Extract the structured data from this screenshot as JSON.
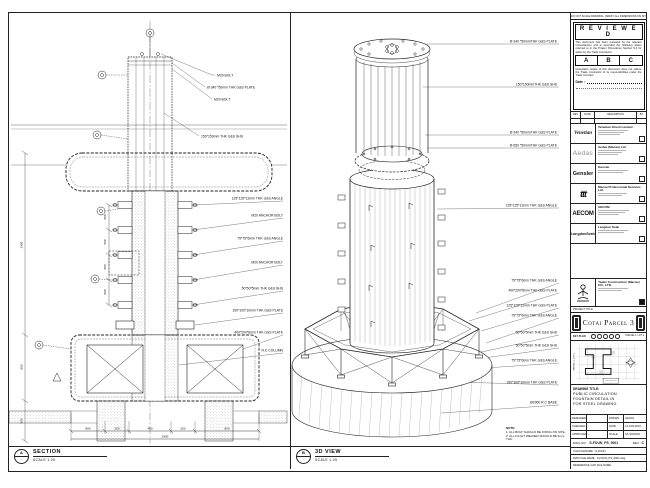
{
  "section_view": {
    "marker": "A",
    "label": "SECTION",
    "scale": "SCALE 1:25",
    "callouts_top": [
      "M20 BOLT",
      "Ø 340 *50mm THK G&S PLATE",
      "M20 BOLT",
      "150*150mm THK G&S SHS"
    ],
    "callouts_right": [
      "125*125*12mm THK G&S ANGLE",
      "M20 ANCHOR BOLT",
      "75*75*6mm THK G&S ANGLE",
      "M20 ANCHOR BOLT",
      "50*50*5mm THK G&S SHS",
      "150*100*10mm THK G&S PLATE",
      "400*200*8mm THK G&S PLATE",
      "R.C COLUMN"
    ],
    "dims_left": [
      "500",
      "500",
      "500",
      "500"
    ],
    "side_dims": [
      "2400",
      "800",
      "500"
    ],
    "dims_bottom": [
      "800",
      "200",
      "450",
      "200",
      "800"
    ],
    "dim_total": "2900"
  },
  "iso_view": {
    "marker": "B",
    "label": "3D VIEW",
    "scale": "SCALE 1:25",
    "callouts": [
      "Ø 340 *50mmTHK G&S PLATE",
      "150*150mmTHK G&S SHS",
      "Ø 340 *50mmTHK G&S PLATE",
      "Ø 650 *50mmTHK G&S PLATE",
      "125*125*12mm THK G&S ANGLE",
      "75*75*6mm THK G&S ANGLE",
      "400*200*8mm THK G&S PLATE",
      "125*125*12mm THK G&S PLATE",
      "75*75*6mm THK G&S ANGLE",
      "50*50*5mm THK G&S SHS",
      "50*50*5mm THK G&S SHS",
      "75*75*6mm THK G&S ANGLE",
      "150*100*10mm THK G&S PLATE",
      "Ø2900 R.C BASE"
    ]
  },
  "notes": {
    "title": "NOTE:",
    "items": [
      "1. ALL BOLT SHOULD BE FIXING ON SITE.",
      "2. ALL FILLET WELDED SHOULD BE 6mm THK."
    ]
  },
  "titleblock": {
    "top_note": "DO NOT SCALE DRAWING. VERIFY ALL DIMENSIONS ON SITE",
    "reviewed": {
      "header": "R E V I E W E D",
      "para1": "This document has been reviewed by the relevant Consultant(s) and is accorded the following status referred to in the Project Procedures Section 5.4 for action by the Trade Contractor.",
      "options": [
        "A",
        "B",
        "C"
      ],
      "para2": "Consultant review of this document does not relieve the Trade Contractor of its responsibilities under the Trade Contract.",
      "date_label": "Date :"
    },
    "rev_table": {
      "headers": [
        "REV",
        "DATE",
        "DESCRIPTION",
        "BY"
      ]
    },
    "consultants": [
      {
        "logo_text": "Venetian",
        "name": "Venetian Orient Limited"
      },
      {
        "logo_text": "Aedas",
        "name": "Aedas (Macau) Ltd."
      },
      {
        "logo_text": "Gensler",
        "name": "Gensler"
      },
      {
        "logo_text": "ttt",
        "name": "Macau Professional Services Ltd."
      },
      {
        "logo_text": "AECOM",
        "name": "AECOM"
      },
      {
        "logo_text": "LangdonSeah",
        "name": "Langdon Seah"
      }
    ],
    "contractor": {
      "name": "Yadex Construction (Macau) CO., LTD."
    },
    "project": {
      "label": "PROJECT TITLE",
      "name": "Cotai Parcel 3"
    },
    "keyplan": {
      "label": "KEY PLAN",
      "parcel_right": "PARCEL 1, LOT 2",
      "parcel_left": "PARCEL 1, LOT 1"
    },
    "drawing_title": {
      "label": "DRAWING TITLE:",
      "lines": [
        "PUBLIC CIRCULATION",
        "FOUNTAIN DETAIL IN",
        "FOR STEEL DRAWING"
      ]
    },
    "fields": {
      "designed_label": "DESIGNED",
      "designed": "",
      "drawn_label": "DRAWN",
      "drawn": "LEUNG",
      "checked_label": "CHECKED",
      "checked": "-",
      "date_label": "DATE",
      "date": "14-JAN-2015",
      "approved_label": "APPROVED",
      "approved": "-",
      "scale_label": "SCALE",
      "scale": "AS SHOWN",
      "dwg_label": "DWG NO :",
      "dwg_no": "S-FOUN_PS_0001",
      "rev_label": "REV :",
      "rev": "C"
    },
    "files": {
      "row1": "CAD FILENAME : S-FOUN",
      "row2": "DWG FILE NAME : S-FOUN_PS_0001.dwg",
      "row3": "REFERENCE CAD FILE NAME :"
    }
  }
}
